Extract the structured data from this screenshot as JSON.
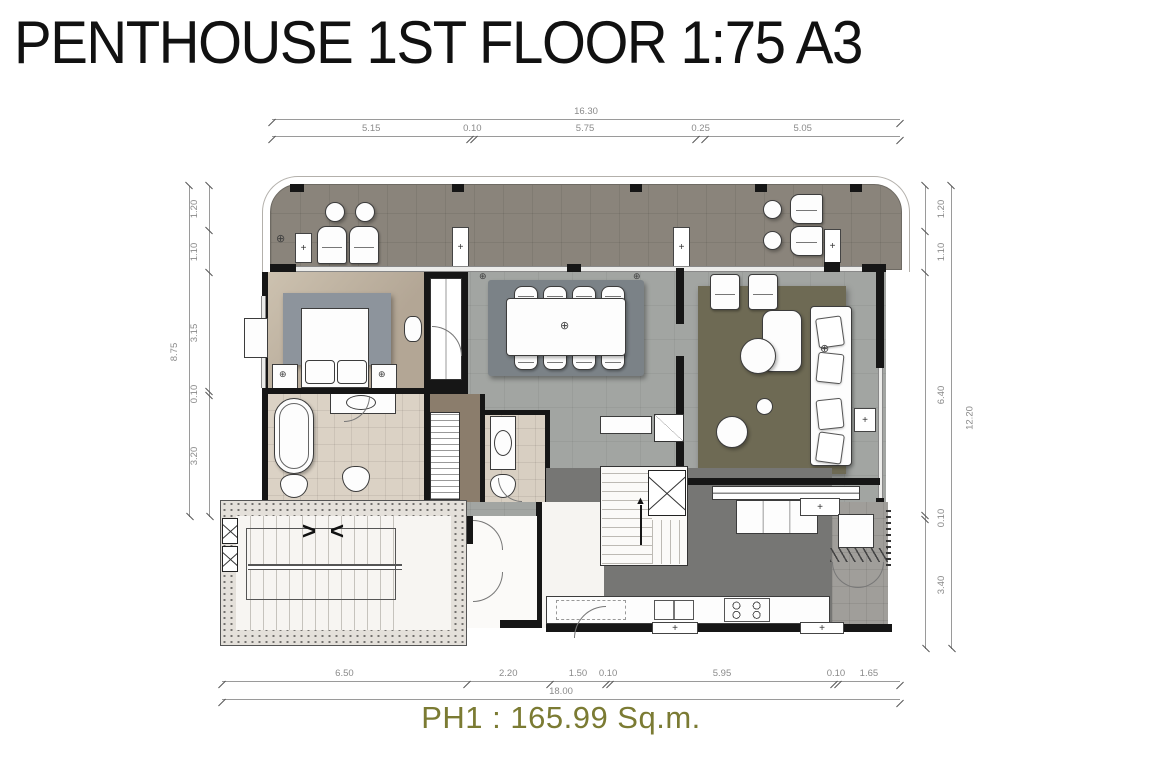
{
  "title": "PENTHOUSE 1ST FLOOR 1:75 A3",
  "area_label": "PH1 : 165.99 Sq.m.",
  "dimensions": {
    "top": {
      "total": "16.30",
      "segments": [
        "5.15",
        "0.10",
        "5.75",
        "0.25",
        "5.05"
      ]
    },
    "bottom": {
      "total": "18.00",
      "segments": [
        "6.50",
        "2.20",
        "1.50",
        "0.10",
        "5.95",
        "0.10",
        "1.65"
      ]
    },
    "left": {
      "total": "8.75",
      "segments": [
        "1.20",
        "1.10",
        "3.15",
        "0.10",
        "3.20"
      ]
    },
    "right": {
      "total": "12.20",
      "segments": [
        "1.20",
        "1.10",
        "6.40",
        "0.10",
        "3.40"
      ]
    }
  },
  "colors": {
    "title": "#111111",
    "area_label": "#7b7b33",
    "dim_text": "#8a8a8a",
    "dim_line": "#9a9a9a",
    "wall": "#161616",
    "terrace_floor": "#8a847b",
    "bedroom_floor": "#b3a695",
    "main_floor": "#a2a5a2",
    "bath_floor": "#dbd2c5",
    "closet_floor": "#8b7d6c",
    "kitchen_floor": "#767674",
    "foyer_floor": "#f6f4f1",
    "terrace2_floor": "#a09e9a",
    "stair_wall": "#e4e0da",
    "rug_bedroom": "#8d949c",
    "rug_dining": "#7b8287",
    "rug_living": "#6e6a54",
    "furniture": "#fdfdfd"
  }
}
